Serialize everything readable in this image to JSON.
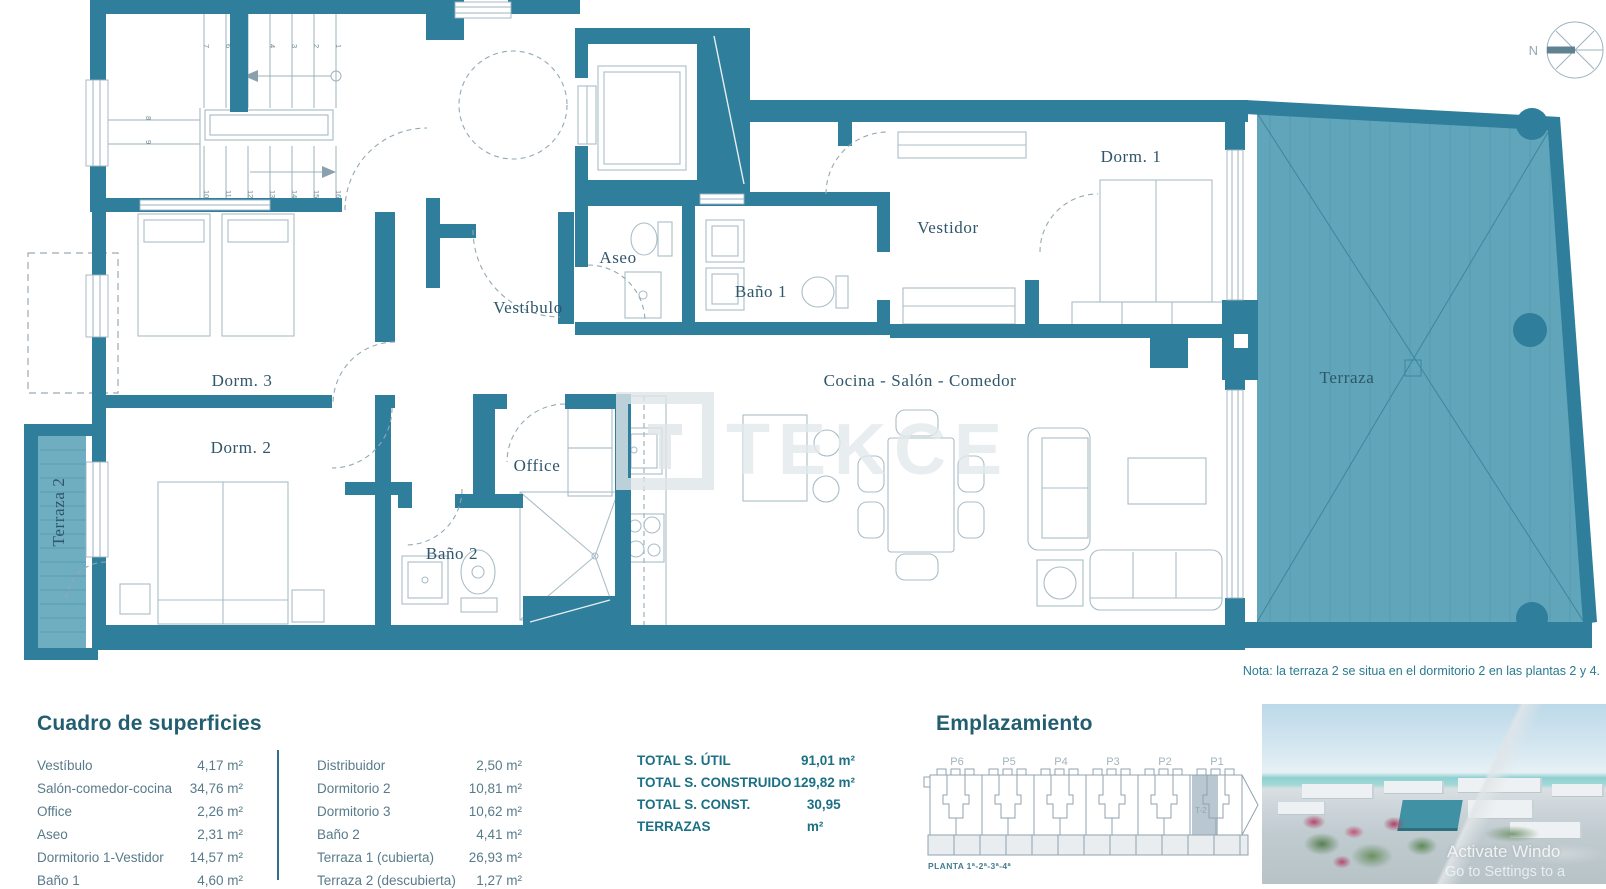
{
  "colors": {
    "wall_teal": "#2e7e9c",
    "terrace_deck": "#61a5ba",
    "deck_stripe": "#4d93a9",
    "furniture_line": "#a9bdc7",
    "room_label": "#2f566b",
    "panel_title": "#235e70",
    "panel_text": "#587b8b",
    "totals_text": "#1c7085",
    "note_text": "#2a7b90",
    "diagram_line": "#8fa3af",
    "highlight_fill": "#b9c7d0",
    "photo_building_teal": "#3f91a3"
  },
  "plan": {
    "rooms": {
      "dorm1": "Dorm. 1",
      "vestidor": "Vestidor",
      "aseo": "Aseo",
      "bano1": "Baño 1",
      "vestibulo": "Vestíbulo",
      "dorm3": "Dorm. 3",
      "dorm2": "Dorm. 2",
      "office": "Office",
      "bano2": "Baño 2",
      "cocina": "Cocina - Salón - Comedor",
      "terraza": "Terraza",
      "terraza2": "Terraza 2"
    },
    "stair_numbers": [
      "1",
      "2",
      "3",
      "4",
      "6",
      "7",
      "8",
      "9",
      "10",
      "11",
      "12",
      "13",
      "14",
      "15",
      "16"
    ],
    "compass": "N"
  },
  "watermark": {
    "brand": "TEKCE"
  },
  "note": "Nota: la terraza 2 se situa en el dormitorio 2 en las plantas 2 y 4.",
  "surfaces": {
    "title": "Cuadro de superficies",
    "left_rows": [
      {
        "label": "Vestíbulo",
        "value": "4,17 m²"
      },
      {
        "label": "Salón-comedor-cocina",
        "value": "34,76 m²"
      },
      {
        "label": "Office",
        "value": "2,26 m²"
      },
      {
        "label": "Aseo",
        "value": "2,31 m²"
      },
      {
        "label": "Dormitorio 1-Vestidor",
        "value": "14,57 m²"
      },
      {
        "label": "Baño 1",
        "value": "4,60 m²"
      }
    ],
    "right_rows": [
      {
        "label": "Distribuidor",
        "value": "2,50 m²"
      },
      {
        "label": "Dormitorio 2",
        "value": "10,81 m²"
      },
      {
        "label": "Dormitorio 3",
        "value": "10,62 m²"
      },
      {
        "label": "Baño 2",
        "value": "4,41 m²"
      },
      {
        "label": "Terraza 1 (cubierta)",
        "value": "26,93 m²"
      },
      {
        "label": "Terraza 2 (descubierta)",
        "value": "1,27 m²"
      }
    ]
  },
  "totals": [
    {
      "label": "TOTAL S. ÚTIL",
      "value": "91,01 m²"
    },
    {
      "label": "TOTAL S. CONSTRUIDO",
      "value": "129,82 m²"
    },
    {
      "label": "TOTAL S. CONST. TERRAZAS",
      "value": "30,95 m²"
    }
  ],
  "emplazamiento": {
    "title": "Emplazamiento",
    "portals": [
      "P6",
      "P5",
      "P4",
      "P3",
      "P2",
      "P1"
    ],
    "highlight": "T-2",
    "caption": "PLANTA 1ª-2ª-3ª-4ª"
  },
  "photo": {
    "watermark_line1": "Activate Windo",
    "watermark_line2": "Go to Settings to a"
  }
}
